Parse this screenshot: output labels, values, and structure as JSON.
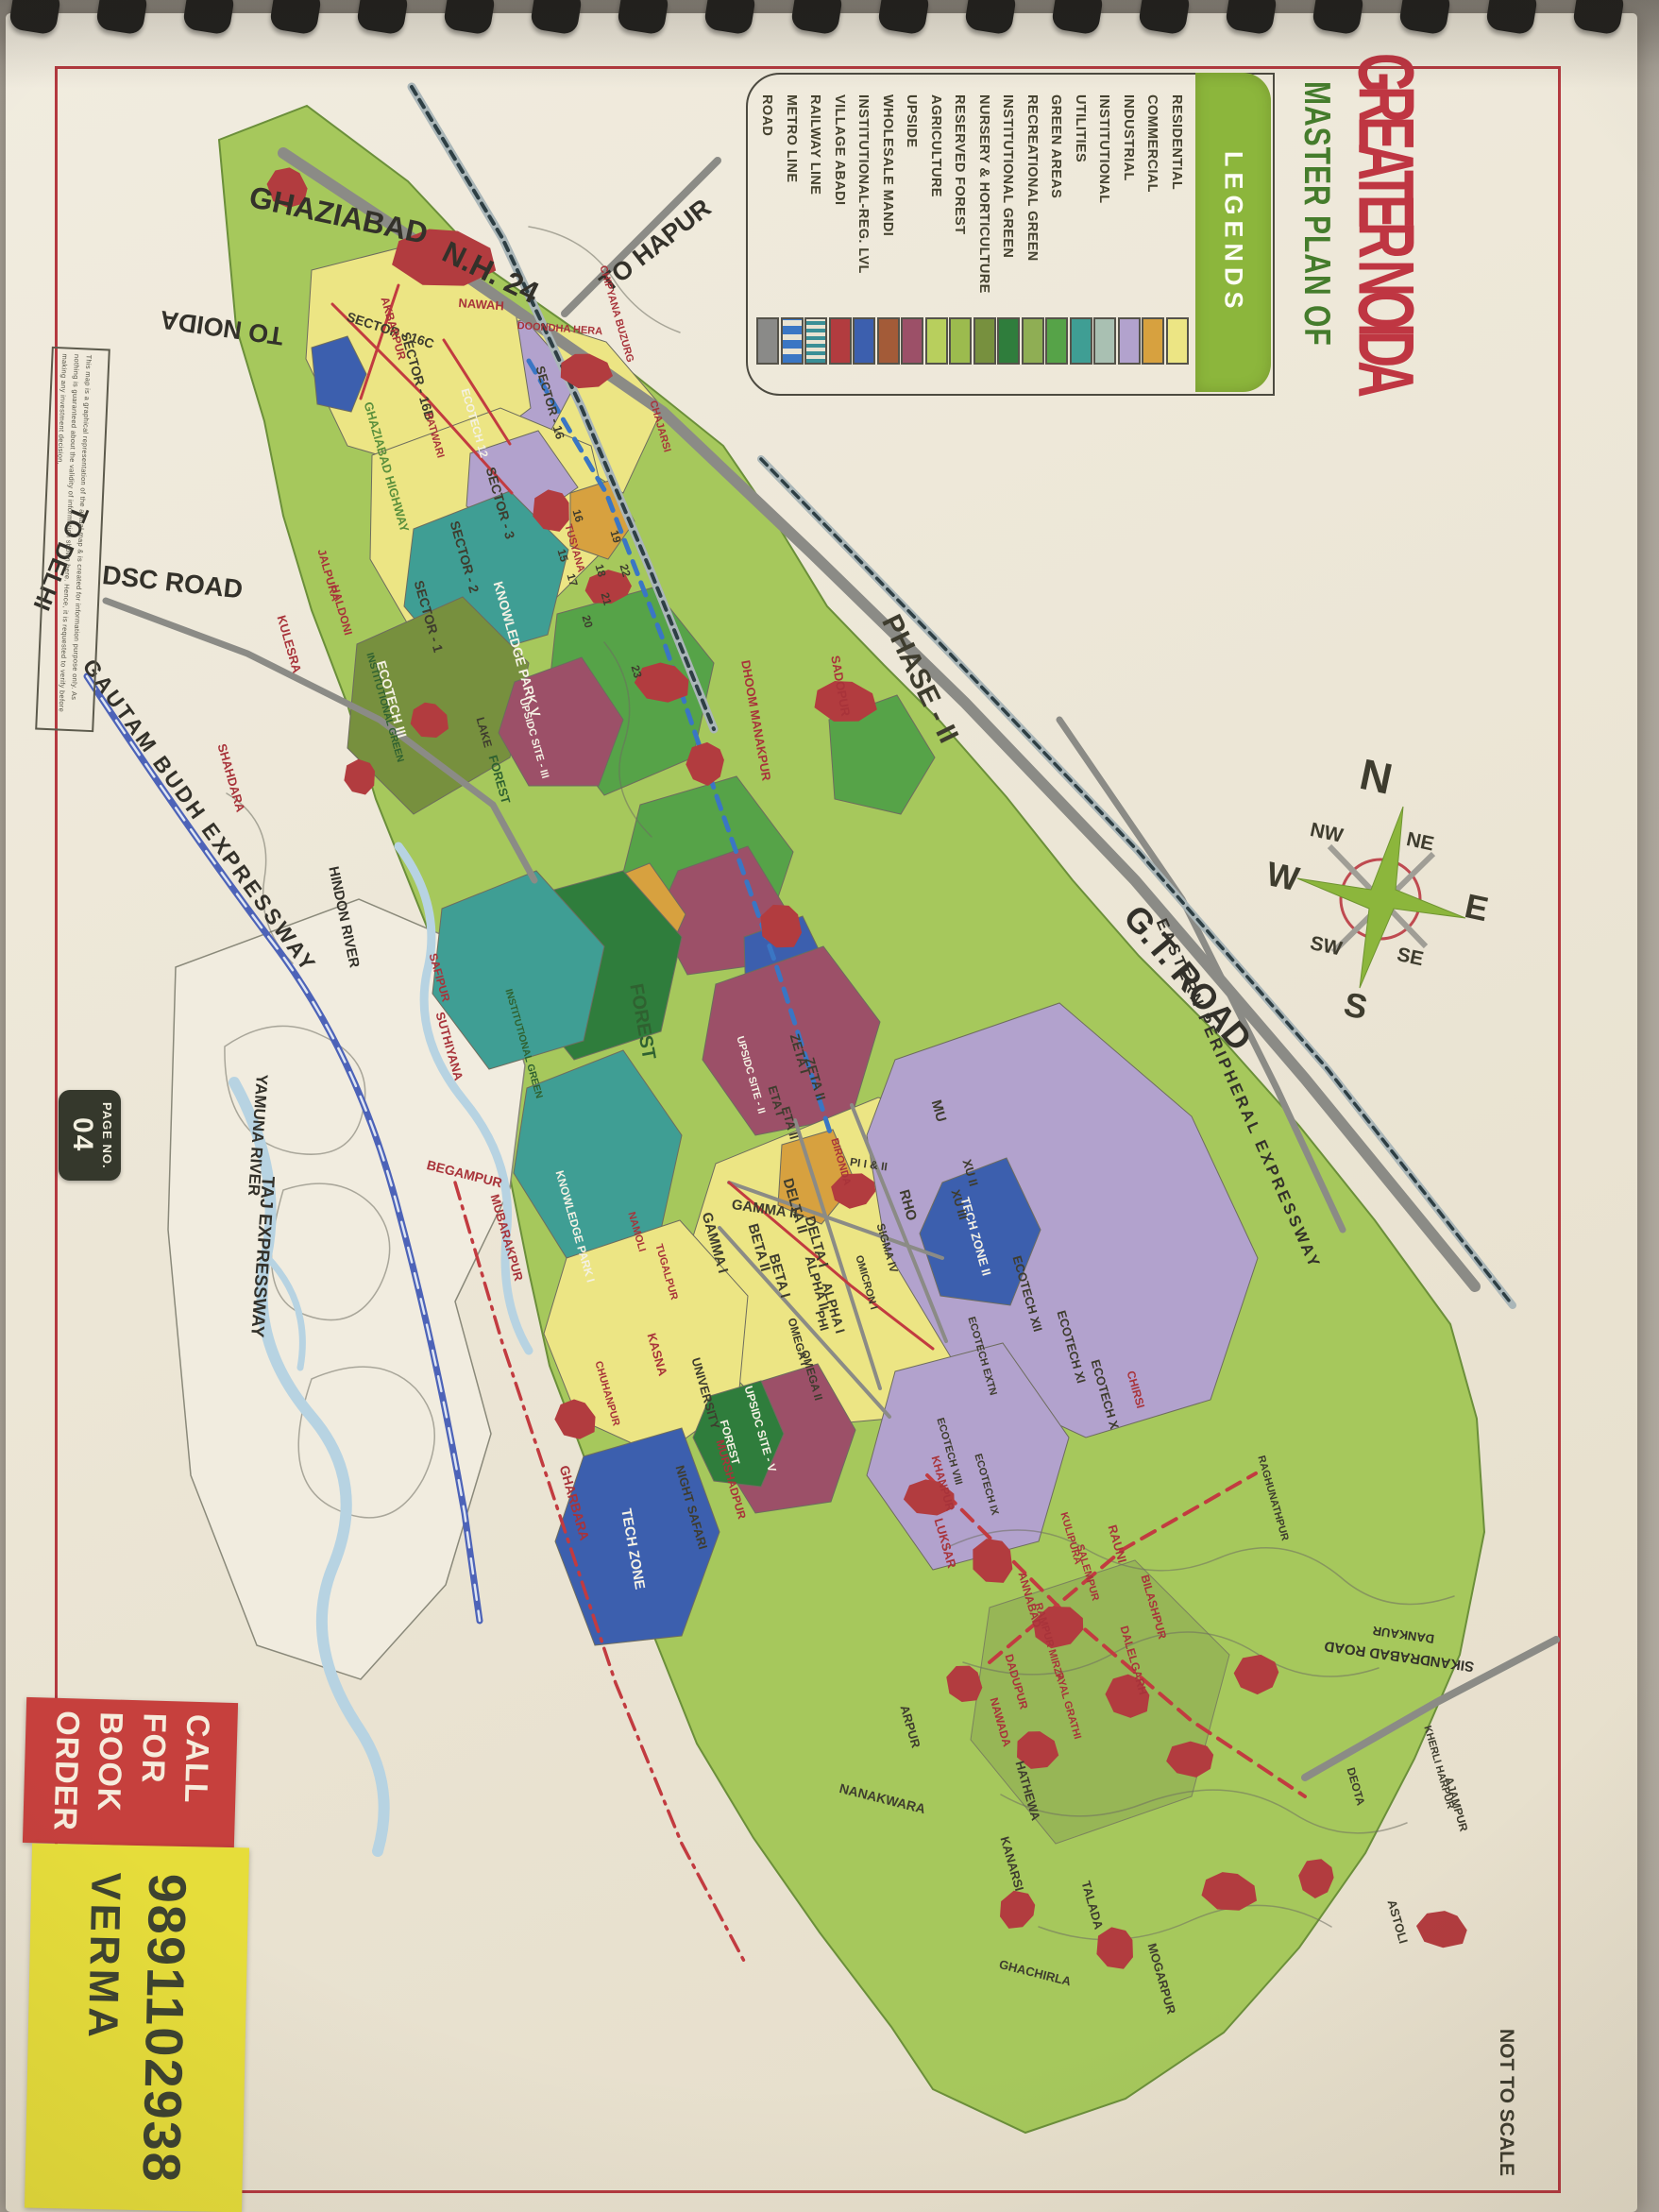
{
  "title": {
    "line1": "MASTER PLAN OF",
    "line2": "GREATER NOIDA"
  },
  "page_badge": {
    "label": "PAGE NO.",
    "number": "04"
  },
  "not_to_scale": "NOT TO SCALE",
  "disclaimer": "This map is a graphical representation of the actual map & is created for information purpose only. As nothing is guaranteed about the validity of information shown here. Hence, it is requested to verify before making any investment decision.",
  "sticker": {
    "line1": "CALL",
    "line2": "FOR",
    "line3": "BOOK",
    "line4": "ORDER",
    "phone": "9891102938",
    "name": "VERMA"
  },
  "legend": {
    "header": "LEGENDS",
    "items": [
      {
        "label": "RESIDENTIAL",
        "color": "#ece584"
      },
      {
        "label": "COMMERCIAL",
        "color": "#d7a13f"
      },
      {
        "label": "INDUSTRIAL",
        "color": "#b2a2cd"
      },
      {
        "label": "INSTITUTIONAL",
        "color": "#a9c0b2"
      },
      {
        "label": "UTILITIES",
        "color": "#3f9e94"
      },
      {
        "label": "GREEN AREAS",
        "color": "#56a348"
      },
      {
        "label": "RECREATIONAL GREEN",
        "color": "#8fae54"
      },
      {
        "label": "INSTITUTIONAL GREEN",
        "color": "#2f7d3c"
      },
      {
        "label": "NURSERY & HORTICULTURE",
        "color": "#77903e"
      },
      {
        "label": "RESERVED FOREST",
        "color": "#9cbb4e"
      },
      {
        "label": "AGRICULTURE",
        "color": "#b8cf5d"
      },
      {
        "label": "UPSIDE",
        "color": "#9c5068"
      },
      {
        "label": "WHOLESALE MANDI",
        "color": "#a35b38"
      },
      {
        "label": "INSTITUTIONAL-REG. LVL",
        "color": "#3c5fae"
      },
      {
        "label": "VILLAGE ABADI",
        "color": "#b23c3f"
      },
      {
        "label": "RAILWAY LINE",
        "color": "#3a8f96",
        "pattern": "hatched"
      },
      {
        "label": "METRO LINE",
        "color": "#3a76c4",
        "pattern": "dashed"
      },
      {
        "label": "ROAD",
        "color": "#8a8a88"
      }
    ]
  },
  "compass": {
    "n": "N",
    "ne": "NE",
    "e": "E",
    "se": "SE",
    "s": "S",
    "sw": "SW",
    "w": "W",
    "nw": "NW"
  },
  "map": {
    "roads": [
      "GHAZIABAD",
      "N.H. 24",
      "TO HAPUR",
      "TO NOIDA",
      "DSC ROAD",
      "TO DELHI",
      "GAUTAM BUDH EXPRESSWAY",
      "HINDON RIVER",
      "YAMUNA RIVER",
      "TAJ EXPRESSWAY",
      "G.T. ROAD",
      "EASTERN PERIPHERAL EXPRESSWAY",
      "SIKANDRABAD ROAD",
      "DANKAUR",
      "GHAZIABAD HIGHWAY"
    ],
    "areas": [
      "PHASE - II",
      "KNOWLEDGE PARK V",
      "ECOTECH III",
      "FOREST",
      "INSTITUTIONAL GREEN",
      "INSTITUTIONAL GREEN",
      "UPSIDC SITE - III",
      "UPSIDC SITE - II",
      "UPSIDC SITE - V",
      "TECH ZONE II",
      "TECH ZONE",
      "UNIVERSITY",
      "NIGHT SAFARI",
      "KNOWLEDGE PARK I",
      "LAKE",
      "FOREST",
      "FOREST",
      "ECOTECH XII",
      "ECOTECH XI",
      "ECOTECH X",
      "ECOTECH EXTN",
      "ECOTECH VIII",
      "ECOTECH IX",
      "ECOTECH 12",
      "MU",
      "XU II",
      "XU III",
      "ZETA I",
      "ZETA II",
      "ETA I",
      "ETA II",
      "DELTA II",
      "DELTA I",
      "GAMMA II",
      "GAMMA I",
      "BETA II",
      "BETA I",
      "ALPHA II",
      "ALPHA I",
      "PI I & II",
      "RHO",
      "SIGMA IV",
      "OMICRON I",
      "PHI",
      "OMEGA I",
      "OMEGA II",
      "SECTOR - 16C",
      "SECTOR - 16B",
      "SECTOR - 16",
      "SECTOR - 3",
      "SECTOR - 2",
      "SECTOR - 1"
    ],
    "villages": [
      "NAWAH",
      "DOONDHA HERA",
      "AKBARPUR",
      "CHIPYANA BUZURG",
      "CHAJARSI",
      "SADOPUR",
      "DHOOM MANAKPUR",
      "TUSYANA",
      "PATWARI",
      "JALPURA",
      "HALDONI",
      "KULESRA",
      "SHAHDARA",
      "BEGAMPUR",
      "MUBARAKPUR",
      "SUTHIYANA",
      "SAFIPUR",
      "NAMOLI",
      "TUGALPUR",
      "BIRONDA",
      "KASNA",
      "CHUHANPUR",
      "GHARBARA",
      "MURSHADPUR",
      "KHANPUR",
      "LUKSAR",
      "ANNABAD",
      "RAMPUR MIRZA",
      "SALEMPUR",
      "KULIPURA",
      "RAUNI",
      "BILASHPUR",
      "DALELGARH",
      "DADUPUR",
      "NAWADA",
      "PYAL GRATHI",
      "ARPUR",
      "NANAKWARA",
      "HATHEWA",
      "KANARSI",
      "TALADA",
      "MOGARPUR",
      "GHACHIRLA",
      "ASTOLI",
      "DEOTA",
      "AJAMPUR",
      "KHERLI HARPUR",
      "CHIRSI",
      "RAGHUNATHPUR"
    ],
    "plot_numbers": [
      "15",
      "16",
      "17",
      "18",
      "19",
      "20",
      "21",
      "22",
      "23"
    ]
  },
  "colors": {
    "page": "#efe9db",
    "border_red": "#b4393f",
    "title_red": "#bf3642",
    "title_green": "#457c2c",
    "legend_banner": "#8cb63c",
    "sticker_red": "#c6403d",
    "sticker_yellow": "#e6dd3a",
    "badge_dark": "#35382c",
    "agriculture_green": "#a6c85c",
    "village_red": "#b23c3f"
  }
}
